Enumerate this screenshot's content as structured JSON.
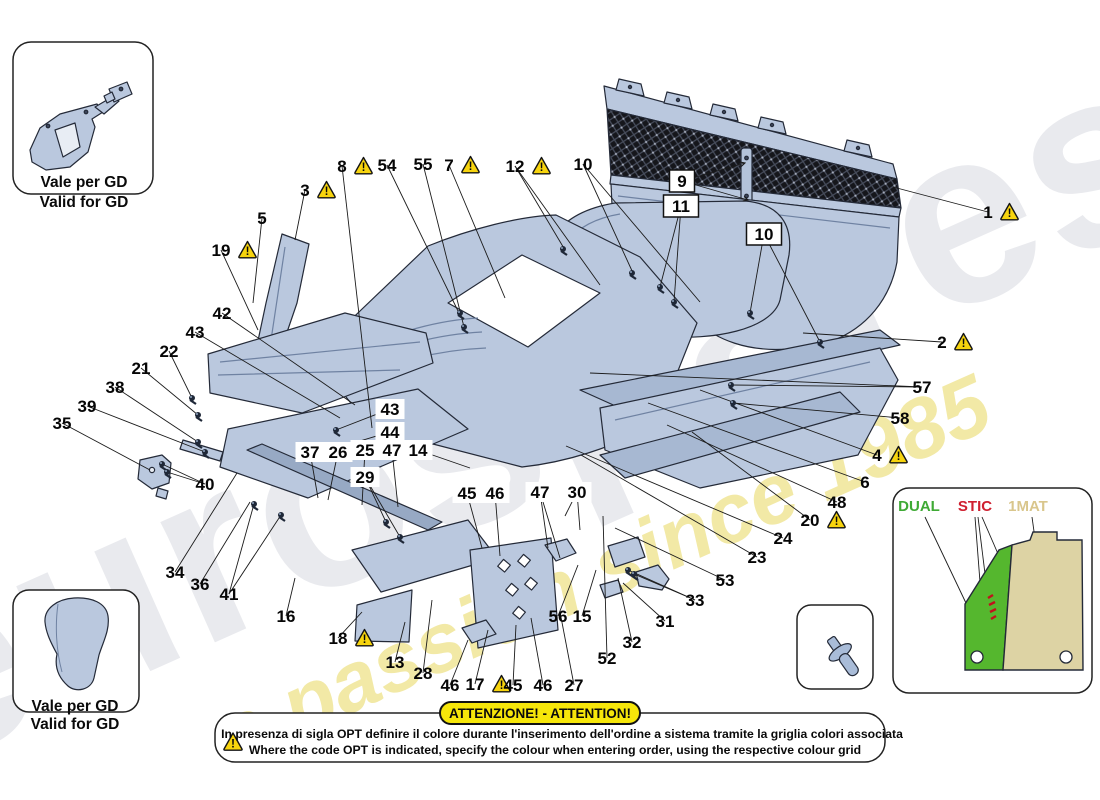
{
  "watermark": {
    "word": "eurospares",
    "slogan": "a passion since 1985"
  },
  "colors": {
    "part_blue": "#bac8de",
    "part_blue_dark": "#a7b8d2",
    "outline": "#242a38",
    "warning_yellow": "#f7d40e",
    "banner_yellow": "#f6e60a",
    "legend_green": "#3faa35",
    "legend_red": "#cf2030",
    "legend_tan": "#d9c68c",
    "watermark_gray": "#e9eaee",
    "watermark_yellow": "#f2e9a6"
  },
  "warning_mark": "!",
  "insets": {
    "top_left": {
      "caption_it": "Vale per GD",
      "caption_en": "Valid for GD"
    },
    "bottom_left": {
      "caption_it": "Vale per GD",
      "caption_en": "Valid for GD"
    }
  },
  "legend": {
    "options": [
      {
        "label": "DUAL",
        "color": "#3faa35"
      },
      {
        "label": "STIC",
        "color": "#cf2030"
      },
      {
        "label": "1MAT",
        "color": "#d9c68c"
      }
    ]
  },
  "banner": {
    "title": "ATTENZIONE! - ATTENTION!",
    "line_it": "In presenza di sigla OPT definire il colore durante l'inserimento dell'ordine a sistema tramite la griglia colori associata",
    "line_en": "Where the code OPT is indicated, specify the colour when entering order, using the respective colour grid"
  },
  "fasteners": [
    [
      563,
      249
    ],
    [
      632,
      273
    ],
    [
      750,
      313
    ],
    [
      820,
      342
    ],
    [
      460,
      313
    ],
    [
      464,
      327
    ],
    [
      192,
      398
    ],
    [
      198,
      415
    ],
    [
      198,
      442
    ],
    [
      205,
      452
    ],
    [
      162,
      464
    ],
    [
      167,
      472
    ],
    [
      254,
      504
    ],
    [
      281,
      515
    ],
    [
      336,
      430
    ],
    [
      340,
      447
    ],
    [
      386,
      522
    ],
    [
      400,
      537
    ],
    [
      628,
      570
    ],
    [
      634,
      574
    ],
    [
      731,
      385
    ],
    [
      733,
      403
    ],
    [
      660,
      287
    ],
    [
      674,
      302
    ],
    [
      63,
      627
    ],
    [
      70,
      692
    ]
  ],
  "callouts": [
    {
      "n": "1",
      "x": 988,
      "y": 212,
      "warn": true,
      "leads": [
        [
          893,
          187
        ]
      ]
    },
    {
      "n": "2",
      "x": 942,
      "y": 342,
      "warn": true,
      "leads": [
        [
          803,
          333
        ]
      ]
    },
    {
      "n": "3",
      "x": 305,
      "y": 190,
      "warn": true,
      "leads": [
        [
          295,
          240
        ]
      ]
    },
    {
      "n": "4",
      "x": 877,
      "y": 455,
      "warn": true,
      "leads": [
        [
          700,
          390
        ]
      ]
    },
    {
      "n": "5",
      "x": 262,
      "y": 218,
      "leads": [
        [
          253,
          303
        ]
      ]
    },
    {
      "n": "6",
      "x": 865,
      "y": 482,
      "leads": [
        [
          648,
          403
        ]
      ]
    },
    {
      "n": "7",
      "x": 449,
      "y": 165,
      "warn": true,
      "leads": [
        [
          505,
          298
        ]
      ]
    },
    {
      "n": "8",
      "x": 342,
      "y": 166,
      "warn": true,
      "leads": [
        [
          372,
          428
        ]
      ]
    },
    {
      "n": "9",
      "x": 682,
      "y": 181,
      "box": "outline",
      "arrow": true,
      "leads": [
        [
          745,
          163
        ],
        [
          748,
          200
        ]
      ]
    },
    {
      "n": "11",
      "x": 681,
      "y": 206,
      "box": "outline",
      "leads": [
        [
          660,
          287
        ],
        [
          674,
          302
        ]
      ]
    },
    {
      "n": "10",
      "x": 764,
      "y": 234,
      "box": "outline",
      "leads": [
        [
          750,
          313
        ],
        [
          820,
          342
        ]
      ]
    },
    {
      "n": "10",
      "x": 583,
      "y": 164,
      "leads": [
        [
          633,
          273
        ],
        [
          700,
          302
        ]
      ]
    },
    {
      "n": "12",
      "x": 515,
      "y": 166,
      "warn": true,
      "leads": [
        [
          565,
          250
        ],
        [
          600,
          285
        ]
      ]
    },
    {
      "n": "54",
      "x": 387,
      "y": 165,
      "leads": [
        [
          459,
          313
        ]
      ]
    },
    {
      "n": "55",
      "x": 423,
      "y": 164,
      "leads": [
        [
          464,
          327
        ]
      ]
    },
    {
      "n": "19",
      "x": 221,
      "y": 250,
      "warn": true,
      "leads": [
        [
          258,
          330
        ]
      ]
    },
    {
      "n": "42",
      "x": 222,
      "y": 313,
      "leads": [
        [
          355,
          405
        ]
      ]
    },
    {
      "n": "43",
      "x": 195,
      "y": 332,
      "leads": [
        [
          340,
          418
        ]
      ]
    },
    {
      "n": "22",
      "x": 169,
      "y": 351,
      "leads": [
        [
          192,
          398
        ]
      ]
    },
    {
      "n": "21",
      "x": 141,
      "y": 368,
      "leads": [
        [
          198,
          415
        ]
      ]
    },
    {
      "n": "38",
      "x": 115,
      "y": 387,
      "leads": [
        [
          198,
          442
        ]
      ]
    },
    {
      "n": "39",
      "x": 87,
      "y": 406,
      "leads": [
        [
          205,
          452
        ]
      ]
    },
    {
      "n": "35",
      "x": 62,
      "y": 423,
      "leads": [
        [
          150,
          470
        ]
      ]
    },
    {
      "n": "40",
      "x": 205,
      "y": 484,
      "leads": [
        [
          162,
          464
        ],
        [
          167,
          472
        ]
      ]
    },
    {
      "n": "34",
      "x": 175,
      "y": 572,
      "leads": [
        [
          237,
          473
        ]
      ]
    },
    {
      "n": "36",
      "x": 200,
      "y": 584,
      "leads": [
        [
          250,
          502
        ]
      ]
    },
    {
      "n": "41",
      "x": 229,
      "y": 594,
      "leads": [
        [
          254,
          504
        ],
        [
          281,
          515
        ]
      ]
    },
    {
      "n": "16",
      "x": 286,
      "y": 616,
      "leads": [
        [
          295,
          578
        ]
      ]
    },
    {
      "n": "43",
      "x": 390,
      "y": 409,
      "box": "chip",
      "leads": [
        [
          336,
          430
        ]
      ]
    },
    {
      "n": "44",
      "x": 390,
      "y": 432,
      "box": "chip",
      "leads": [
        [
          340,
          447
        ]
      ]
    },
    {
      "n": "37",
      "x": 310,
      "y": 452,
      "box": "chip",
      "leads": [
        [
          318,
          498
        ]
      ]
    },
    {
      "n": "26",
      "x": 338,
      "y": 452,
      "box": "chip",
      "leads": [
        [
          328,
          500
        ]
      ]
    },
    {
      "n": "25",
      "x": 365,
      "y": 450,
      "box": "chip",
      "leads": [
        [
          362,
          505
        ]
      ]
    },
    {
      "n": "47",
      "x": 392,
      "y": 450,
      "box": "chip",
      "leads": [
        [
          398,
          507
        ]
      ]
    },
    {
      "n": "14",
      "x": 418,
      "y": 450,
      "box": "chip",
      "leads": [
        [
          470,
          468
        ]
      ]
    },
    {
      "n": "29",
      "x": 365,
      "y": 477,
      "box": "chip",
      "leads": [
        [
          386,
          522
        ],
        [
          400,
          537
        ]
      ]
    },
    {
      "n": "45",
      "x": 467,
      "y": 493,
      "box": "chip",
      "leads": [
        [
          482,
          548
        ]
      ]
    },
    {
      "n": "46",
      "x": 495,
      "y": 493,
      "box": "chip",
      "leads": [
        [
          500,
          556
        ]
      ]
    },
    {
      "n": "47",
      "x": 540,
      "y": 492,
      "box": "chip",
      "leads": [
        [
          548,
          548
        ],
        [
          560,
          558
        ]
      ]
    },
    {
      "n": "30",
      "x": 577,
      "y": 492,
      "box": "chip",
      "leads": [
        [
          565,
          516
        ],
        [
          580,
          530
        ]
      ]
    },
    {
      "n": "18",
      "x": 338,
      "y": 638,
      "warn": true,
      "leads": [
        [
          362,
          612
        ]
      ]
    },
    {
      "n": "13",
      "x": 395,
      "y": 662,
      "leads": [
        [
          405,
          622
        ]
      ]
    },
    {
      "n": "28",
      "x": 423,
      "y": 673,
      "leads": [
        [
          432,
          600
        ]
      ]
    },
    {
      "n": "46",
      "x": 450,
      "y": 685,
      "leads": [
        [
          468,
          640
        ]
      ]
    },
    {
      "n": "17",
      "x": 475,
      "y": 684,
      "warn": true,
      "leads": [
        [
          488,
          630
        ]
      ]
    },
    {
      "n": "45",
      "x": 513,
      "y": 685,
      "leads": [
        [
          516,
          625
        ]
      ]
    },
    {
      "n": "46",
      "x": 543,
      "y": 685,
      "leads": [
        [
          531,
          618
        ]
      ]
    },
    {
      "n": "27",
      "x": 574,
      "y": 685,
      "leads": [
        [
          560,
          612
        ]
      ]
    },
    {
      "n": "56",
      "x": 558,
      "y": 616,
      "leads": [
        [
          578,
          565
        ]
      ]
    },
    {
      "n": "15",
      "x": 582,
      "y": 616,
      "leads": [
        [
          596,
          570
        ]
      ]
    },
    {
      "n": "52",
      "x": 607,
      "y": 658,
      "leads": [
        [
          603,
          516
        ]
      ]
    },
    {
      "n": "32",
      "x": 632,
      "y": 642,
      "leads": [
        [
          618,
          578
        ]
      ]
    },
    {
      "n": "31",
      "x": 665,
      "y": 621,
      "leads": [
        [
          623,
          583
        ]
      ]
    },
    {
      "n": "33",
      "x": 695,
      "y": 600,
      "leads": [
        [
          628,
          570
        ],
        [
          634,
          574
        ]
      ]
    },
    {
      "n": "53",
      "x": 725,
      "y": 580,
      "leads": [
        [
          615,
          528
        ]
      ]
    },
    {
      "n": "23",
      "x": 757,
      "y": 557,
      "leads": [
        [
          581,
          455
        ]
      ]
    },
    {
      "n": "24",
      "x": 783,
      "y": 538,
      "leads": [
        [
          566,
          446
        ]
      ]
    },
    {
      "n": "20",
      "x": 810,
      "y": 520,
      "warn": true,
      "leads": [
        [
          692,
          432
        ]
      ]
    },
    {
      "n": "48",
      "x": 837,
      "y": 502,
      "leads": [
        [
          667,
          425
        ]
      ]
    },
    {
      "n": "57",
      "x": 922,
      "y": 387,
      "leads": [
        [
          731,
          385
        ],
        [
          590,
          373
        ]
      ]
    },
    {
      "n": "58",
      "x": 900,
      "y": 418,
      "leads": [
        [
          733,
          403
        ]
      ]
    },
    {
      "n": "50",
      "x": 53,
      "y": 61,
      "leads": [
        [
          62,
          110
        ]
      ]
    },
    {
      "n": "51",
      "x": 104,
      "y": 61,
      "leads": [
        [
          113,
          88
        ]
      ]
    },
    {
      "n": "29",
      "x": 107,
      "y": 601,
      "leads": [
        [
          90,
          618
        ]
      ]
    },
    {
      "n": "49",
      "x": 29,
      "y": 667,
      "leads": [
        [
          63,
          627
        ],
        [
          70,
          690
        ]
      ]
    },
    {
      "n": "59",
      "x": 819,
      "y": 624,
      "leads": [
        [
          838,
          650
        ]
      ]
    }
  ]
}
